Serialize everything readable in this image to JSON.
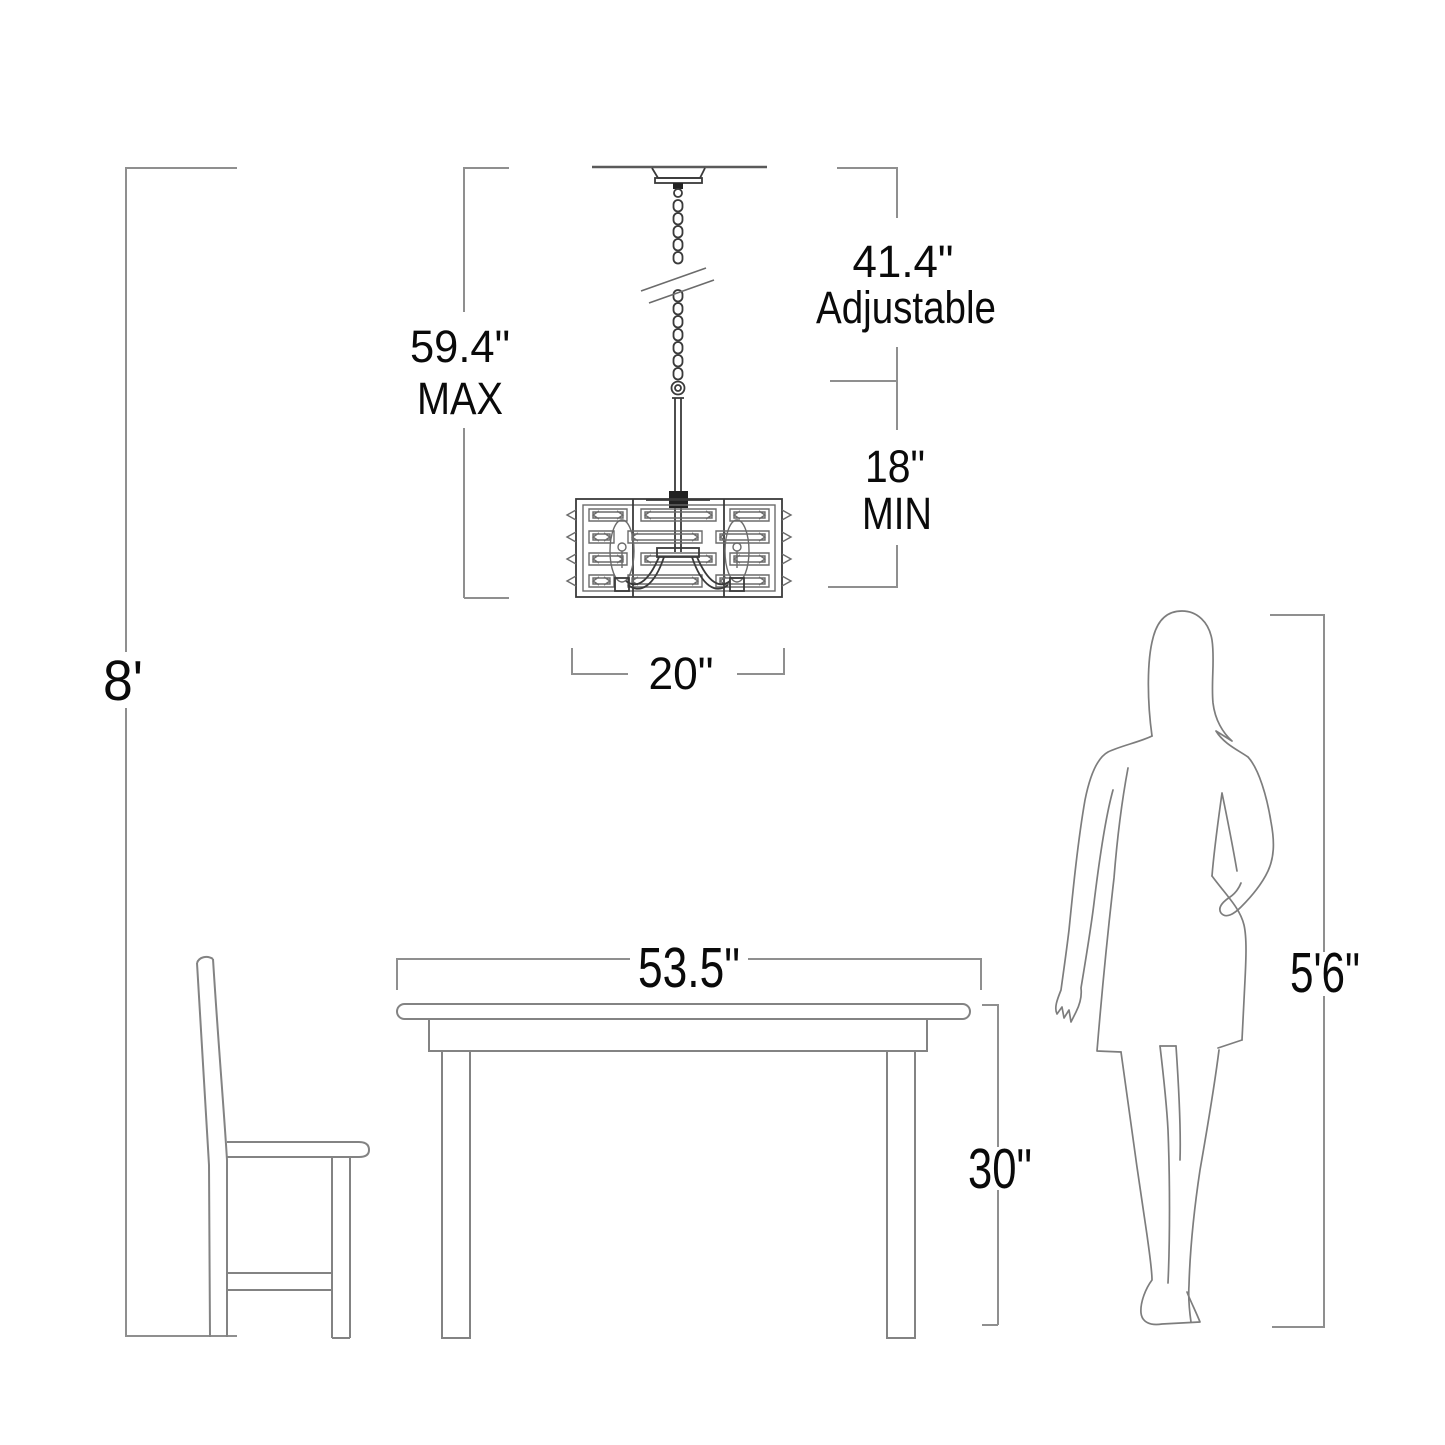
{
  "diagram_title": "Chandelier mounting dimension diagram",
  "labels": {
    "ceiling_height": "8'",
    "max_height": "59.4\"",
    "max_qualifier": "MAX",
    "adjustable_length": "41.4\"",
    "adjustable_qualifier": "Adjustable",
    "min_length": "18\"",
    "min_qualifier": "MIN",
    "fixture_width": "20\"",
    "table_width": "53.5\"",
    "table_height": "30\"",
    "person_height": "5'6\""
  },
  "colors": {
    "background": "#ffffff",
    "dimension_line": "#8f8f8f",
    "fixture_line": "#3a3a3a",
    "furniture_line": "#838383",
    "text": "#0a0a0a"
  }
}
